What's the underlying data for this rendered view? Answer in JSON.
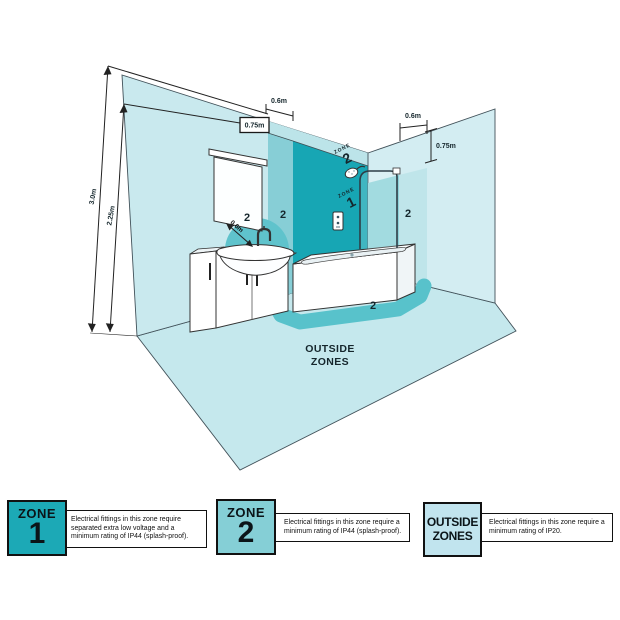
{
  "colors": {
    "zone1_teal": "#17a6b4",
    "band_medium": "#87ced6",
    "band_upper": "#bce4e9",
    "right_corner_band": "#8ed3da",
    "right_band_light": "#bfe5ea",
    "wall_light": "#c9e9ee",
    "right_wall_light": "#d3edf2",
    "floor_light": "#c5e8ed",
    "floor_band": "#58c2cb",
    "semicircle": "#5fc3cc"
  },
  "diagram": {
    "dims": {
      "height_total": "3.0m",
      "height_zone": "2.25m",
      "left_band_width": "0.6m",
      "left_drop": "0.75m",
      "right_band_width": "0.6m",
      "right_drop": "0.75m",
      "basin_radius": "0.6m"
    },
    "zone_stack": {
      "word": "ZONE",
      "zone1_num": "1",
      "zone2_num": "2"
    },
    "markers": {
      "basin": "2",
      "left_wall": "2",
      "right_wall": "2",
      "floor": "2"
    },
    "outside_label": {
      "line1": "OUTSIDE",
      "line2": "ZONES"
    }
  },
  "legend": [
    {
      "title": "ZONE",
      "number": "1",
      "desc": "Electrical fittings in this zone require separated extra low voltage and a minimum rating of IP44 (splash-proof).",
      "box_color": "#1ca9b6"
    },
    {
      "title": "ZONE",
      "number": "2",
      "desc": "Electrical fittings in this zone require a minimum rating of IP44 (splash-proof).",
      "box_color": "#85cfd6"
    },
    {
      "title": "OUTSIDE",
      "number": "ZONES",
      "desc": "Electrical fittings in this zone require a minimum rating of IP20.",
      "box_color": "#c1e4ee"
    }
  ]
}
